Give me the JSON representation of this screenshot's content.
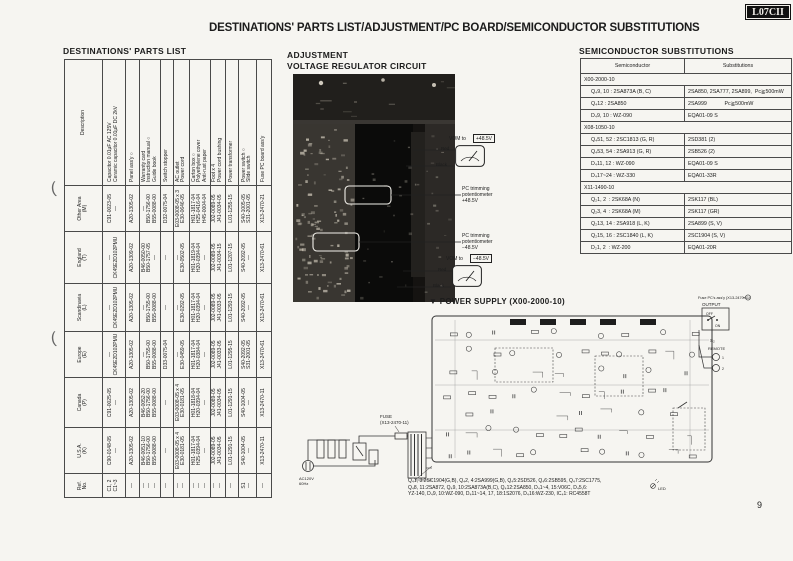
{
  "page": {
    "badge": "L07CII",
    "title": "DESTINATIONS' PARTS LIST/ADJUSTMENT/PC BOARD/SEMICONDUCTOR SUBSTITUTIONS",
    "page_number": "9"
  },
  "parts_list": {
    "heading": "DESTINATIONS' PARTS LIST",
    "headers": [
      "Ref.\nNo.",
      "U.S.A.\n(K)",
      "Canada\n(P)",
      "Europe\n(E)",
      "Scandinavia\n(L)",
      "England\n(T)",
      "Other Area\n(M)",
      "Description"
    ],
    "rows": [
      [
        "C1, 2\nC1~3",
        "C90-0148-05\n—",
        "C91-0025-05\n—",
        "—\nCK45E2D102PMU",
        "—\nCK45E2D102PMU",
        "—\nCK45E2D102PMU",
        "C91-0023-05\n—",
        "Capacitor 0.01μF AC 125V\nCeramic capacitor 0.01μF DC 2kV"
      ],
      [
        "—",
        "A20-1305-02",
        "A20-1305-02",
        "A20-1305-02",
        "A20-1305-02",
        "A20-1309-02",
        "A20-1305-02",
        "Panel ass'y ○"
      ],
      [
        "—\n—\n—",
        "B46-0051-10\nB50-1756-00\nB55-0088-00",
        "B46-0052-20\nB50-1756-00\nB55-0088-00",
        "—\nB50-1755-00\nB55-0088-00",
        "—\nB50-1755-00\nB55-0088-00",
        "B46-0050-00\nB50-1757-05\n—",
        "—\nB50-1756-00\nB55-0088-00",
        "Warranty card\nInstruction manual ○\nGuide book"
      ],
      [
        "—",
        "—",
        "—",
        "D33-0075-04",
        "—",
        "—",
        "D32-0075-04",
        "Switch stopper"
      ],
      [
        "—\n—",
        "E03-0008-05 x 4\nE30-0181-05",
        "E03-0008-05 x 4\nE30-0181-05",
        "—\nE30-0459-05",
        "—\nE30-0292-05",
        "—\nE30-0502-05",
        "E03-0008-05 x 3\nE30-0646-05",
        "AC outlet\nPower cord"
      ],
      [
        "—\n—\n—",
        "H01-1817-04\nH25-0394-04\n—",
        "H01-1818-04\nH20-0394-04\n—",
        "H01-1817-04\nH20-0384-04\n—",
        "H01-1817-04\nH20-0394-04\n—",
        "H01-1819-04\nH20-0394-04\n—",
        "H01-1817-04\nH25-0416-04\nH45-0004-04",
        "Carton box ○\nPolyethylene cover\nAnti-rust paper"
      ],
      [
        "—\n—",
        "J02-0089-05\nJ41-0034-05",
        "J02-0089-05\nJ41-0034-05",
        "J02-0089-05\nJ41-0033-05",
        "J02-0089-05\nJ41-0033-05",
        "J02-0089-05\nJ41-0034-15",
        "J02-0089-05\nJ41-0034-05",
        "Foot x 4\nPower cord bushing"
      ],
      [
        "—",
        "L01-1291-15",
        "L01-1291-15",
        "L01-1295-15",
        "L01-1293-15",
        "L01-1207-15",
        "L01-1255-15",
        "Power transformer"
      ],
      [
        "S1\n—",
        "S40-1004-05\n—",
        "S40-1004-05\n—",
        "S40-2092-05\nS31-2001-05",
        "S40-2092-05\n—",
        "S40-2092-05\n—",
        "S40-1005-05\nS31-2001-05",
        "Power switch ○\nSlide switch"
      ],
      [
        "—",
        "X13-2470-11",
        "X13-2470-11",
        "X13-2470-61",
        "X13-2470-61",
        "X13-2470-61",
        "X13-2470-21",
        "Fuse PC board ass'y"
      ]
    ]
  },
  "adjustment": {
    "heading": "ADJUSTMENT",
    "subheading": "VOLTAGE REGULATOR CIRCUIT",
    "vom_plus": {
      "label": "VOM to",
      "value": "+48.5V",
      "red": "Red",
      "black": "Black"
    },
    "trim_plus": "PC trimming\npotentiometer\n+48.5V",
    "trim_minus": "PC trimming\npotentiometer\n−48.5V",
    "vom_minus": {
      "label": "VOM to",
      "value": "−48.5V",
      "red": "Red",
      "black": "Black"
    }
  },
  "semiconductor": {
    "heading": "SEMICONDUCTOR SUBSTITUTIONS",
    "headers": {
      "semiconductor": "Semiconductor",
      "substitutions": "Substitutions"
    },
    "groups": [
      {
        "board": "X00-2000-10",
        "rows": [
          [
            "Q₄9, 10 : 2SA873A (B, C)",
            "2SA850, 2SA777, 2SA899,  Pc≧500mW"
          ],
          [
            "Q₄12 : 2SA850",
            "2SA999            Pc≧500mW"
          ],
          [
            "D₄9, 10 : WZ-090",
            "EQA01-09 S"
          ]
        ]
      },
      {
        "board": "X08-1050-10",
        "rows": [
          [
            "Q₄51, 52 : 2SC1813 (G, R)",
            "2SD381 (2)"
          ],
          [
            "Q₄53, 54 : 2SA913 (G, R)",
            "2SB526 (2)"
          ],
          [
            "D₄11, 12 : WZ-090",
            "EQA01-09 S"
          ],
          [
            "D₄17~24 : WZ-330",
            "EQA01-33R"
          ]
        ]
      },
      {
        "board": "X11-1490-10",
        "rows": [
          [
            "Q₂1, 2  : 2SK68A (N)",
            "2SK117 (BL)"
          ],
          [
            "Q₂3, 4  : 2SK68A (M)",
            "2SK117 (GR)"
          ],
          [
            "Q₂13, 14 : 2SA918 (L, K)",
            "2SA899 (S, V)"
          ],
          [
            "Q₂15, 16 : 2SC1840 (L, K)",
            "2SC1904 (S, V)"
          ],
          [
            "D₂1, 2  : WZ-200",
            "EQA01-20R"
          ]
        ]
      }
    ]
  },
  "power_supply": {
    "heading": "▼ POWER SUPPLY  (X00-2000-10)",
    "fuse_label_1": "FUSE",
    "fuse_label_2": "(X13-2470-11)",
    "ac_line1": "AC120V",
    "ac_line2": "60Hz",
    "fuse_pc_label": "Fuse PC's ass'y (X13-2470-11)",
    "output": "OUTPUT",
    "off": "OFF",
    "on": "ON",
    "s2": "S₂",
    "remote": "REMOTE",
    "terminal1": "1",
    "terminal2": "2",
    "led": "LED",
    "notes": [
      "Q₄1, 3:2SC1904(G,B), Q₄2, 4:2SA999(G,B), Q₄5:2SD526, Q₄6:2SB595, Q₄7:2SC1775,",
      "Q₄8, 11:2SA872, Q₄9, 10:2SA873A(B,C), Q₄12:2SA850, D₄1~4, 15:V06C, D₄5,6:",
      "YZ-140, D₄9, 10:WZ-090, D₄11~14, 17, 18:1S2076, D₄16:WZ-230, IC₄1: RC4558T"
    ]
  }
}
